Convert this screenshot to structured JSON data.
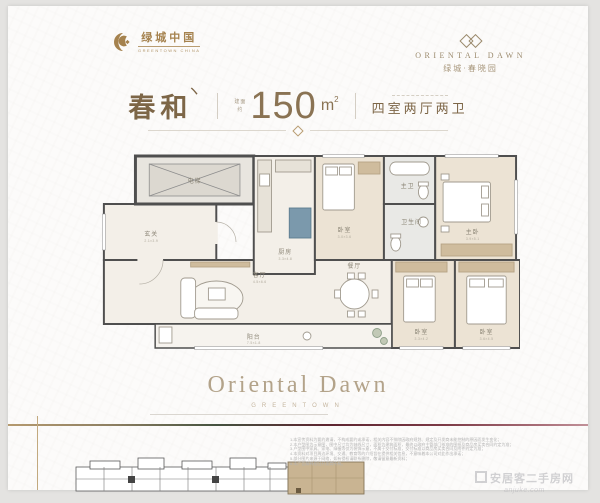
{
  "header": {
    "greentown_logo": {
      "cn": "绿城中国",
      "en": "GREENTOWN CHINA"
    },
    "oriental_logo": {
      "en": "ORIENTAL DAWN",
      "cn": "绿城·春晓园"
    }
  },
  "title_bar": {
    "unit_name": "春和",
    "unit_stroke": "ヽ",
    "area_label_line1": "建面",
    "area_label_line2": "约",
    "area_value": "150",
    "area_unit": "m",
    "area_sup": "2",
    "layout_text": "四室两厅两卫"
  },
  "floorplan": {
    "rooms": [
      {
        "name": "电梯",
        "dim": ""
      },
      {
        "name": "玄关",
        "dim": "2.1×3.9"
      },
      {
        "name": "厨房",
        "dim": "3.3×4.8"
      },
      {
        "name": "卧室",
        "dim": "3.0×3.6"
      },
      {
        "name": "主卫",
        "dim": ""
      },
      {
        "name": "卫生间",
        "dim": ""
      },
      {
        "name": "主卧",
        "dim": "3.9×5.1"
      },
      {
        "name": "客厅",
        "dim": "4.5×6.6"
      },
      {
        "name": "餐厅",
        "dim": "3.6×4.2"
      },
      {
        "name": "阳台",
        "dim": "7.5×1.8"
      },
      {
        "name": "卧室",
        "dim": "3.3×4.2"
      },
      {
        "name": "卧室",
        "dim": "3.6×4.5"
      }
    ]
  },
  "center_watermark": {
    "title": "Oriental Dawn",
    "sub": "GREENTOWN"
  },
  "disclaimer": {
    "lines": [
      "1.本宣传资料为要约邀请，不构成要约或承诺，相关内容不排除因政府规划、规定及开发商未能控制的原因而发生变化；",
      "2.本户型图为示意图，图中尺寸均为轴线尺寸，面积为建筑面积，最终以政府主管部门核准的图纸及商品房买卖合同约定为准；",
      "3.户型图中家具、家电、绿植等仅为装饰示意，不属于交付标准，交付标准以商品房买卖合同及附件约定为准；",
      "4.本资料对项目周边环境、交通、教育等的介绍旨在提供相关信息，不意味着本公司对此作出承诺；",
      "5.部分图片来源于网络，如有侵权请联系删除，敬请留意最新资料；",
      "6.本广告解释权归开发商所有。"
    ]
  },
  "corner_watermark": {
    "line1": "安居客二手房网",
    "line2": "anjuke.com"
  },
  "colors": {
    "accent_gold": "#a5824e",
    "title_brown": "#7d6647",
    "area_brown": "#8a7353",
    "wall": "#4f4f4f",
    "cabinet_tan": "#cfbc9d",
    "kitchen_blue": "#7b99ac",
    "siteplan_highlight": "#c9b492",
    "gradient_green": "#44523f",
    "gradient_maroon": "#5d2530"
  }
}
